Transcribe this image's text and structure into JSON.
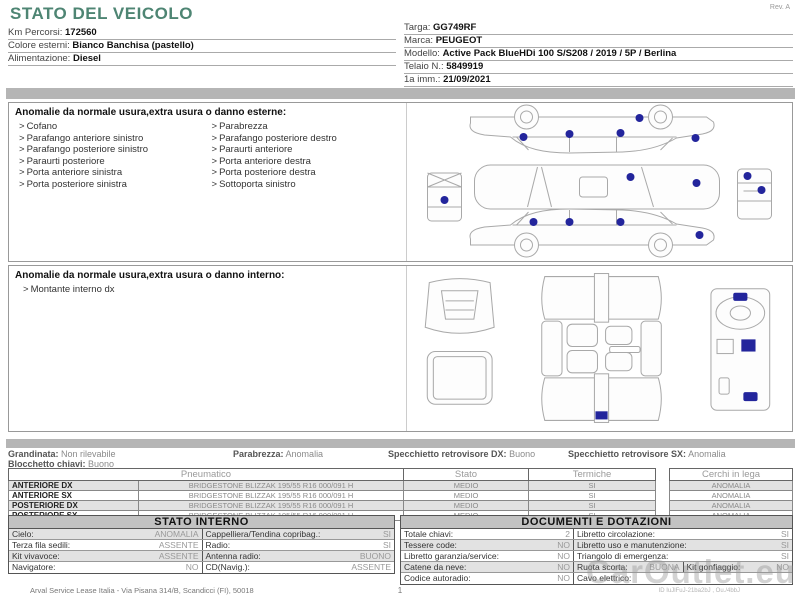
{
  "page": {
    "title": "STATO DEL VEICOLO",
    "rev": "Rev. A",
    "footer_left": "Arval Service Lease Italia - Via Pisana 314/B, Scandicci (FI), 50018",
    "footer_page": "1",
    "watermark": "CarOutlet.eu",
    "footer_id": "ID IuJlFuJ-21ba2bJ , Ou./4bbJ"
  },
  "vehicle_info": {
    "left": [
      {
        "label": "Km Percorsi:",
        "value": "172560"
      },
      {
        "label": "Colore esterni:",
        "value": "Bianco Banchisa (pastello)"
      },
      {
        "label": "Alimentazione:",
        "value": "Diesel"
      }
    ],
    "right": [
      {
        "label": "Targa:",
        "value": "GG749RF"
      },
      {
        "label": "Marca:",
        "value": "PEUGEOT"
      },
      {
        "label": "Modello:",
        "value": "Active Pack BlueHDi 100 S/S208 / 2019 / 5P / Berlina"
      },
      {
        "label": "Telaio N.:",
        "value": "5849919"
      },
      {
        "label": "1a imm.:",
        "value": "21/09/2021"
      }
    ]
  },
  "exterior": {
    "header": "Anomalie da normale usura,extra usura o danno esterne:",
    "bullet": ">",
    "col1": [
      "Cofano",
      "Parafango anteriore sinistro",
      "Parafango posteriore sinistro",
      "Paraurti posteriore",
      "Porta anteriore sinistra",
      "Porta posteriore sinistra"
    ],
    "col2": [
      "Parabrezza",
      "Parafango posteriore destro",
      "Paraurti anteriore",
      "Porta anteriore destra",
      "Porta posteriore destra",
      "Sottoporta sinistro"
    ]
  },
  "interior": {
    "header": "Anomalie da normale usura,extra usura o danno interno:",
    "items": [
      "Montante interno dx"
    ]
  },
  "status_line": {
    "items": [
      {
        "label": "Grandinata:",
        "value": "Non rilevabile"
      },
      {
        "label": "Parabrezza:",
        "value": "Anomalia"
      },
      {
        "label": "Specchietto retrovisore DX:",
        "value": "Buono"
      },
      {
        "label": "Specchietto retrovisore SX:",
        "value": "Anomalia"
      }
    ],
    "second": {
      "label": "Blocchetto chiavi:",
      "value": "Buono"
    }
  },
  "tires": {
    "headers": {
      "pneumatico": "Pneumatico",
      "stato": "Stato",
      "termiche": "Termiche",
      "cerchi": "Cerchi in lega"
    },
    "rows": [
      {
        "name": "ANTERIORE DX",
        "spec": "BRIDGESTONE  BLIZZAK 195/55 R16 000/091 H",
        "stato": "MEDIO",
        "termiche": "SI",
        "cerchi": "ANOMALIA"
      },
      {
        "name": "ANTERIORE SX",
        "spec": "BRIDGESTONE  BLIZZAK 195/55 R16 000/091 H",
        "stato": "MEDIO",
        "termiche": "SI",
        "cerchi": "ANOMALIA"
      },
      {
        "name": "POSTERIORE DX",
        "spec": "BRIDGESTONE  BLIZZAK 195/55 R16 000/091 H",
        "stato": "MEDIO",
        "termiche": "SI",
        "cerchi": "ANOMALIA"
      },
      {
        "name": "POSTERIORE SX",
        "spec": "BRIDGESTONE  BLIZZAK 195/55 R16 000/091 H",
        "stato": "MEDIO",
        "termiche": "SI",
        "cerchi": "ANOMALIA"
      }
    ]
  },
  "stato_interno": {
    "title": "STATO INTERNO",
    "rows": [
      {
        "l1": "Cielo:",
        "v1": "ANOMALIA",
        "l2": "Cappelliera/Tendina copribag.:",
        "v2": "SI"
      },
      {
        "l1": "Terza fila sedili:",
        "v1": "ASSENTE",
        "l2": "Radio:",
        "v2": "SI"
      },
      {
        "l1": "Kit vivavoce:",
        "v1": "ASSENTE",
        "l2": "Antenna radio:",
        "v2": "BUONO"
      },
      {
        "l1": "Navigatore:",
        "v1": "NO",
        "l2": "CD(Navig.):",
        "v2": "ASSENTE"
      }
    ]
  },
  "documenti": {
    "title": "DOCUMENTI E DOTAZIONI",
    "rows": [
      {
        "l1": "Totale chiavi:",
        "v1": "2",
        "l2": "Libretto circolazione:",
        "v2": "SI"
      },
      {
        "l1": "Tessere code:",
        "v1": "NO",
        "l2": "Libretto uso e manutenzione:",
        "v2": "SI"
      },
      {
        "l1": "Libretto garanzia/service:",
        "v1": "NO",
        "l2": "Triangolo di emergenza:",
        "v2": "SI"
      },
      {
        "l1": "Catene da neve:",
        "v1": "NO",
        "l2": "Ruota scorta:",
        "v2": "BUONA",
        "l3": "Kit gonfiaggio:",
        "v3": "NO"
      },
      {
        "l1": "Codice autoradio:",
        "v1": "NO",
        "l2": "Cavo elettrico:",
        "v2": ""
      }
    ]
  },
  "colors": {
    "accent": "#4e8573",
    "marker": "#23259c",
    "bar": "#b5b5b5"
  }
}
